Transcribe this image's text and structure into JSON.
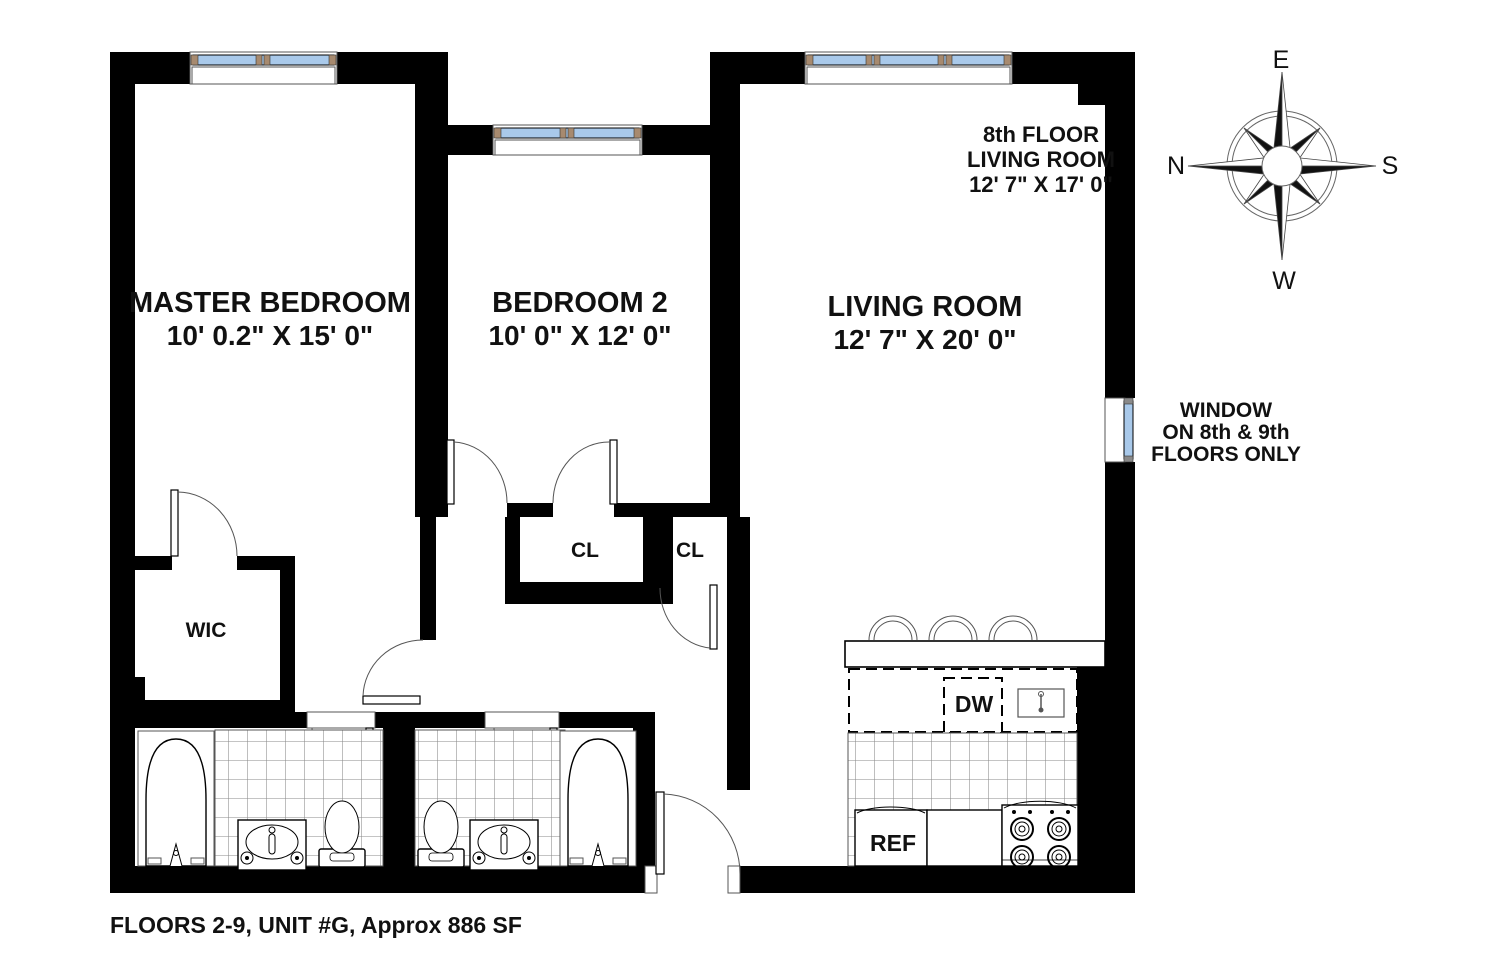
{
  "rooms": {
    "master_bedroom": {
      "name": "MASTER BEDROOM",
      "dimensions": "10' 0.2\" X 15' 0\""
    },
    "bedroom_2": {
      "name": "BEDROOM 2",
      "dimensions": "10' 0\" X 12' 0\""
    },
    "living_room": {
      "name": "LIVING ROOM",
      "dimensions": "12' 7\" X 20' 0\""
    }
  },
  "annotations": {
    "eighth_floor_note": {
      "line1": "8th FLOOR",
      "line2": "LIVING ROOM",
      "line3": "12' 7\" X 17' 0\""
    },
    "window_note": {
      "line1": "WINDOW",
      "line2": "ON 8th & 9th",
      "line3": "FLOORS ONLY"
    }
  },
  "closets": {
    "walk_in": "WIC",
    "closet_1": "CL",
    "closet_2": "CL"
  },
  "appliances": {
    "dishwasher": "DW",
    "refrigerator": "REF"
  },
  "compass": {
    "top": "E",
    "right": "S",
    "bottom": "W",
    "left": "N"
  },
  "footer": {
    "text": "FLOORS 2-9, UNIT #G, Approx 886 SF"
  },
  "colors": {
    "wall": "#000000",
    "glass": "#A9C9EA",
    "frame_accent": "#A78A6F",
    "background": "#FFFFFF"
  }
}
